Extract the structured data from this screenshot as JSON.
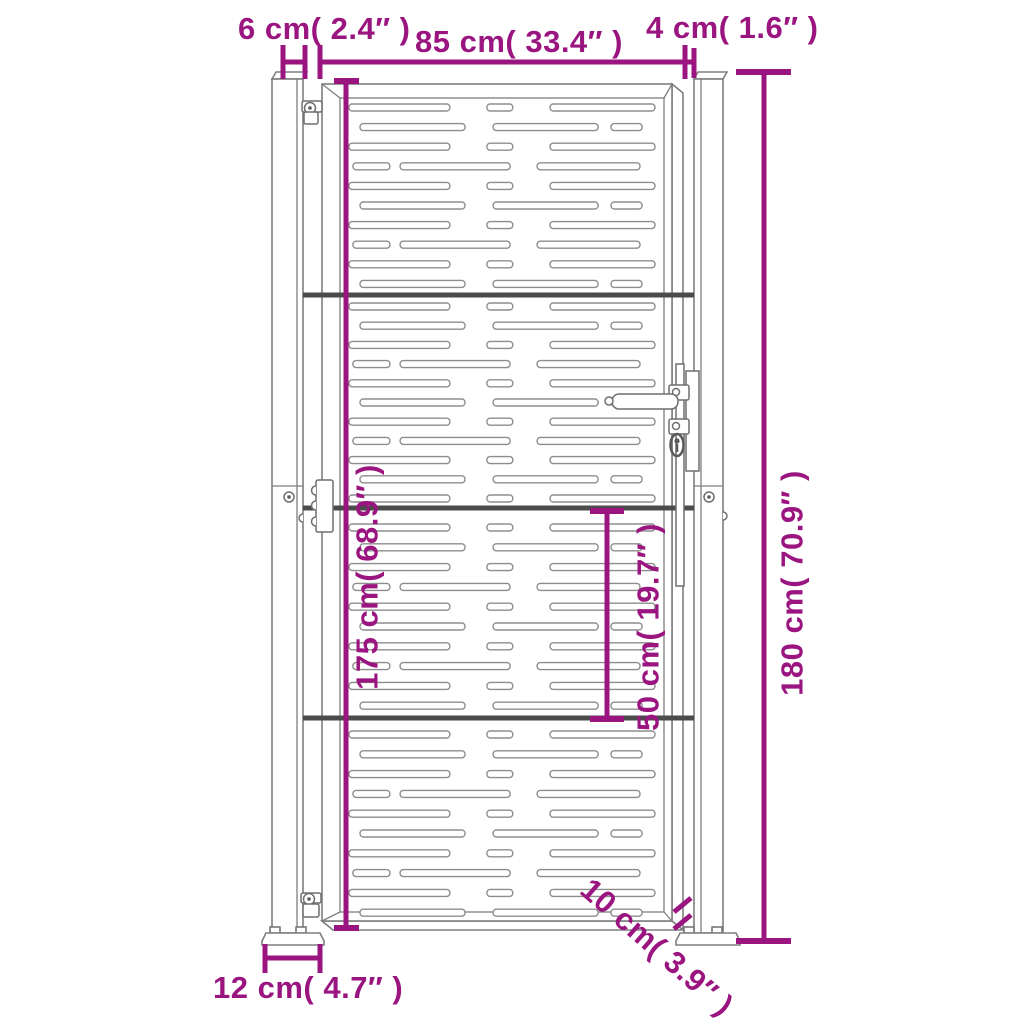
{
  "diagram_title": "garden gate dimension drawing",
  "colors": {
    "dimension": "#9A1580",
    "outline": "#7e7e7e",
    "slot": "#8d8d8d",
    "rail": "#4b4b4b",
    "detail": "#6f6f6f"
  },
  "labels": {
    "post_width": "6 cm( 2.4″ )",
    "gate_width": "85 cm( 33.4″ )",
    "gap_width": "4 cm( 1.6″ )",
    "gate_height": "175 cm( 68.9″ )",
    "total_height": "180 cm( 70.9″ )",
    "panel_height": "50 cm( 19.7″ )",
    "ground_clearance": "10 cm( 3.9″ )",
    "base_plate_width": "12 cm( 4.7″ )"
  },
  "gate_pattern": {
    "slot_area": {
      "x": 348,
      "width": 308,
      "slot_height": 7,
      "corner_radius": 3.2
    },
    "row_types": {
      "A": [
        [
          0.003,
          0.328
        ],
        [
          0.451,
          0.084
        ],
        [
          0.656,
          0.341
        ]
      ],
      "B": [
        [
          0.039,
          0.341
        ],
        [
          0.471,
          0.341
        ],
        [
          0.854,
          0.101
        ]
      ],
      "C": [
        [
          0.016,
          0.12
        ],
        [
          0.169,
          0.357
        ],
        [
          0.614,
          0.334
        ]
      ]
    },
    "sections": [
      {
        "y_start": 104,
        "spacing": 19.6,
        "rows": [
          "A",
          "B",
          "A",
          "C",
          "A",
          "B",
          "A",
          "C",
          "A",
          "B"
        ]
      },
      {
        "y_start": 303,
        "spacing": 19.2,
        "rows": [
          "A",
          "B",
          "A",
          "C",
          "A",
          "B",
          "A",
          "C",
          "A",
          "B",
          "A"
        ]
      },
      {
        "y_start": 524,
        "spacing": 19.8,
        "rows": [
          "A",
          "B",
          "A",
          "C",
          "A",
          "B",
          "A",
          "C",
          "A",
          "B"
        ]
      },
      {
        "y_start": 731,
        "spacing": 19.8,
        "rows": [
          "A",
          "B",
          "A",
          "C",
          "A",
          "B",
          "A",
          "C",
          "A",
          "B"
        ]
      }
    ]
  }
}
